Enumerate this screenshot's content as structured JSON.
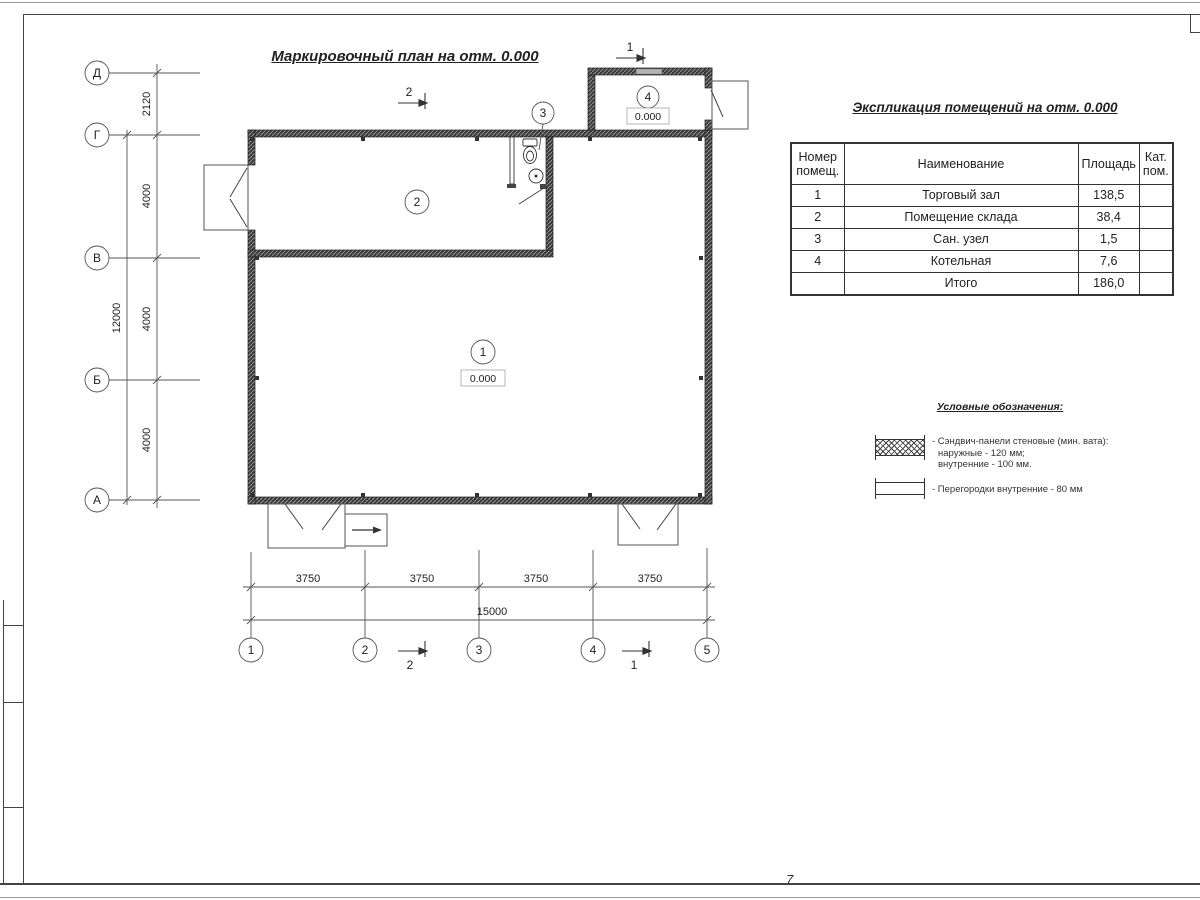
{
  "plan": {
    "title": "Маркировочный план на отм. 0.000",
    "axes_left": [
      "Д",
      "Г",
      "В",
      "Б",
      "А"
    ],
    "axes_bottom": [
      "1",
      "2",
      "3",
      "4",
      "5"
    ],
    "dims_left": [
      "2120",
      "4000",
      "4000",
      "4000"
    ],
    "dim_left_total": "12000",
    "dims_bottom": [
      "3750",
      "3750",
      "3750",
      "3750"
    ],
    "dim_bottom_total": "15000",
    "rooms": [
      {
        "number": "1",
        "elevation": "0.000"
      },
      {
        "number": "2"
      },
      {
        "number": "3"
      },
      {
        "number": "4",
        "elevation": "0.000"
      }
    ],
    "sections": {
      "s1": "1",
      "s2": "2"
    }
  },
  "table": {
    "title": "Экспликация помещений на отм. 0.000",
    "headers": {
      "number": [
        "Номер",
        "помещ."
      ],
      "name": "Наименование",
      "area": "Площадь",
      "cat": [
        "Кат.",
        "пом."
      ]
    },
    "rows": [
      {
        "number": "1",
        "name": "Торговый зал",
        "area": "138,5",
        "cat": ""
      },
      {
        "number": "2",
        "name": "Помещение склада",
        "area": "38,4",
        "cat": ""
      },
      {
        "number": "3",
        "name": "Сан. узел",
        "area": "1,5",
        "cat": ""
      },
      {
        "number": "4",
        "name": "Котельная",
        "area": "7,6",
        "cat": ""
      },
      {
        "number": "",
        "name": "Итого",
        "area": "186,0",
        "cat": ""
      }
    ]
  },
  "legend": {
    "title": "Условные обозначения:",
    "items": [
      {
        "symbol": "sandwich-panel-hatch-swatch",
        "lines": [
          "- Сэндвич-панели стеновые (мин. вата):",
          "наружные - 120 мм;",
          "внутренние - 100 мм."
        ]
      },
      {
        "symbol": "internal-partition-swatch",
        "lines": [
          "- Перегородки внутренние - 80 мм"
        ]
      }
    ]
  },
  "sheet": {
    "page_mark": "7"
  }
}
